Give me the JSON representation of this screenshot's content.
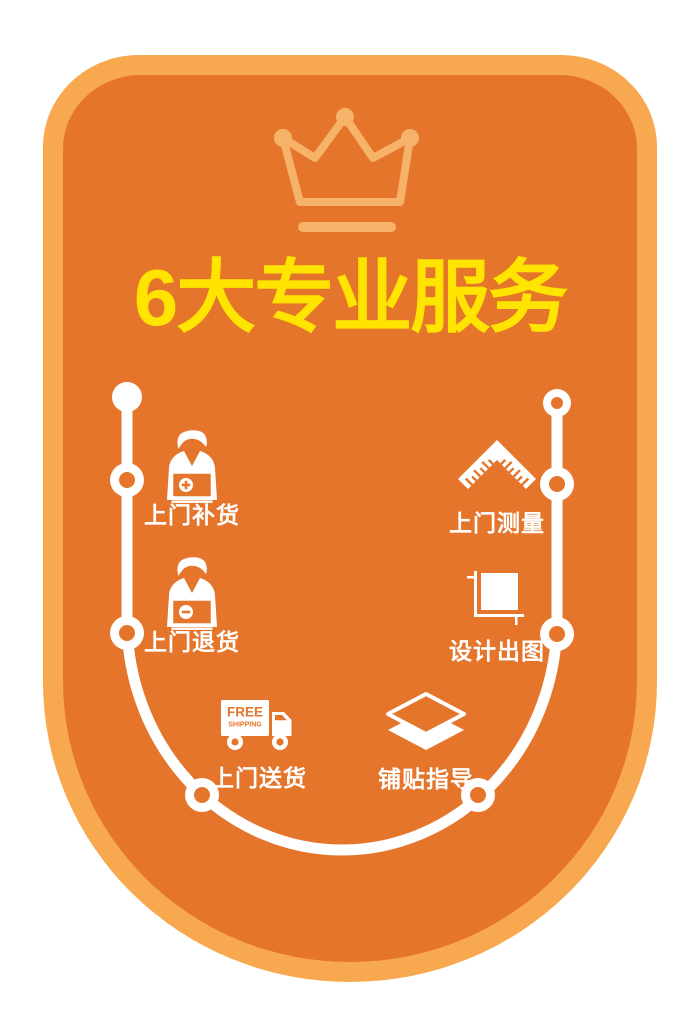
{
  "title": {
    "text": "6大专业服务"
  },
  "crown": {
    "icon": "crown-icon"
  },
  "services": [
    {
      "id": "restock",
      "label": "上门补货",
      "icon": "person-box-plus-icon"
    },
    {
      "id": "return",
      "label": "上门退货",
      "icon": "person-box-minus-icon"
    },
    {
      "id": "delivery",
      "label": "上门送货",
      "icon": "delivery-truck-icon",
      "truck": {
        "line1": "FREE",
        "line2": "SHIPPING"
      }
    },
    {
      "id": "measure",
      "label": "上门测量",
      "icon": "angle-ruler-icon"
    },
    {
      "id": "design",
      "label": "设计出图",
      "icon": "drawing-plot-icon"
    },
    {
      "id": "tiling",
      "label": "铺贴指导",
      "icon": "stacked-tiles-icon"
    }
  ],
  "colors": {
    "card_border": "#F8A84E",
    "card_background": "#E5752B",
    "crown": "#F6B269",
    "title_text": "#FFE400",
    "icons_and_timeline": "#FFFFFF"
  }
}
